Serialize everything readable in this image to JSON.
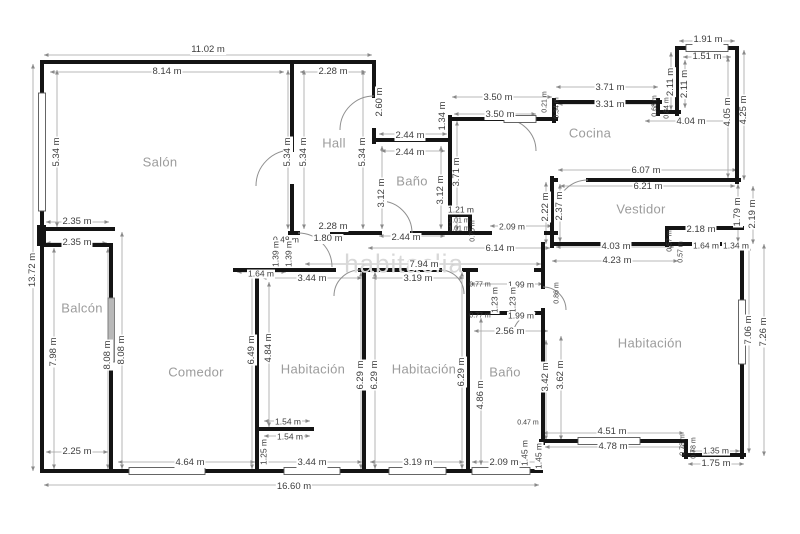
{
  "watermark": "habitaclia",
  "rooms": {
    "salon": "Salón",
    "hall": "Hall",
    "banyo1": "Baño",
    "cocina": "Cocina",
    "vestidor": "Vestidor",
    "balcon": "Balcón",
    "comedor": "Comedor",
    "hab1": "Habitación",
    "hab2": "Habitación",
    "banyo2": "Baño",
    "hab3": "Habitación"
  },
  "dims": {
    "n1": "11.02 m",
    "n2": "8.14 m",
    "n3": "2.28 m",
    "n4": "2.60 m",
    "n5": "5.34 m",
    "n6": "5.34 m",
    "n7": "5.34 m",
    "n8": "5.34 m",
    "n9": "2.35 m",
    "n10": "2.35 m",
    "n11": "2.28 m",
    "n12": "0.48 m",
    "n13": "1.80 m",
    "n14": "1.39 m",
    "n15": "1.39 m",
    "n16": "1.64 m",
    "n17": "13.72 m",
    "n18": "7.98 m",
    "n19": "8.08 m",
    "n20": "8.08 m",
    "n21": "2.25 m",
    "n22": "2.44 m",
    "n23": "2.44 m",
    "n24": "3.12 m",
    "n25": "3.12 m",
    "n26": "2.44 m",
    "n27": "1.21 m",
    "n28": "1.01 m",
    "n29": "1.01 m",
    "n30": "0.75 m",
    "n31": "1.34 m",
    "n32": "3.50 m",
    "n33": "3.50 m",
    "n34": "0.21 m",
    "n35": "0.34 m",
    "n36": "3.71 m",
    "n37": "3.31 m",
    "n38": "3.71 m",
    "n39": "1.91 m",
    "n40": "1.51 m",
    "n41": "2.11 m",
    "n42": "2.11 m",
    "n43": "0.68 m",
    "n44": "0.84 m",
    "n45": "4.04 m",
    "n46": "4.05 m",
    "n47": "4.25 m",
    "n48": "6.07 m",
    "n49": "6.21 m",
    "n50": "2.22 m",
    "n51": "2.37 m",
    "n52": "2.09 m",
    "n53": "6.14 m",
    "n54": "7.94 m",
    "n55": "4.03 m",
    "n56": "4.23 m",
    "n57": "2.18 m",
    "n58": "1.64 m",
    "n59": "1.34 m",
    "n60": "0.57 m",
    "n61": "0.57 m",
    "n62": "1.79 m",
    "n63": "2.19 m",
    "n64": "0.86 m",
    "n65": "0.77 m",
    "n66": "1.99 m",
    "n67": "1.23 m",
    "n68": "1.23 m",
    "n69": "0.77 m",
    "n70": "1.99 m",
    "n71": "2.56 m",
    "n72": "3.42 m",
    "n73": "3.62 m",
    "n74": "4.86 m",
    "n75": "7.06 m",
    "n76": "7.26 m",
    "n77": "3.44 m",
    "n78": "3.19 m",
    "n79": "6.49 m",
    "n80": "4.84 m",
    "n81": "6.29 m",
    "n82": "6.29 m",
    "n83": "6.29 m",
    "n84": "1.54 m",
    "n85": "1.54 m",
    "n86": "1.25 m",
    "n87": "0.47 m",
    "n88": "1.45 m",
    "n89": "1.45 m",
    "n90": "4.51 m",
    "n91": "4.78 m",
    "n92": "0.78 m",
    "n93": "0.78 m",
    "n94": "1.35 m",
    "n95": "1.75 m",
    "n96": "2.09 m",
    "n97": "4.64 m",
    "n98": "3.44 m",
    "n99": "3.19 m",
    "n100": "16.60 m"
  }
}
